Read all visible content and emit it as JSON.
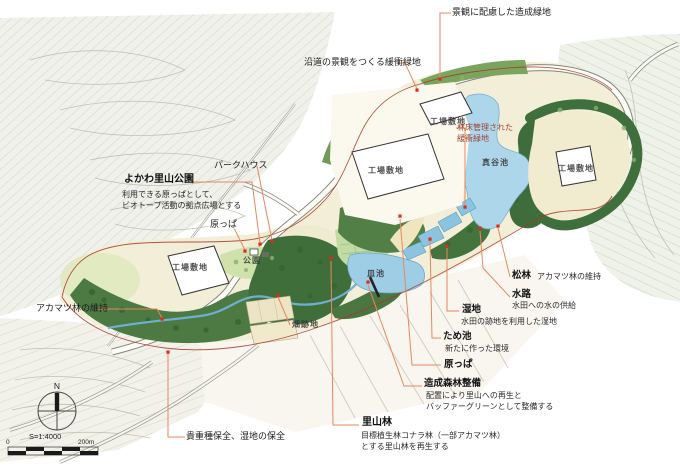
{
  "annotations": {
    "zosei_ryokuchi": {
      "label": "景観に配慮した造成緑地"
    },
    "enro": {
      "label": "沿道の景観をつくる緩衝緑地"
    },
    "parkhouse": {
      "label": "パークハウス"
    },
    "yokawa": {
      "title": "よかわ里山公園",
      "desc1": "利用できる原っぱとして、",
      "desc2": "ビオトープ活動の拠点広場とする"
    },
    "harappa_left": {
      "label": "原っぱ"
    },
    "akamatsu_left": {
      "label": "アカマツ林の維持"
    },
    "kicho": {
      "label": "貴重種保全、湿地の保全"
    },
    "rinsho": {
      "line1": "林床管理された",
      "line2": "緩衝緑地"
    },
    "matsubayashi": {
      "title": "松林",
      "desc": "アカマツ林の維持"
    },
    "suiro": {
      "title": "水路",
      "desc": "水田への水の供給"
    },
    "shitchi": {
      "title": "湿地",
      "desc": "水田の跡地を利用した湿地"
    },
    "tameike": {
      "title": "ため池",
      "desc": "新たに作った環境"
    },
    "harappa_right": {
      "label": "原っぱ"
    },
    "zosei_shinrin": {
      "title": "造成森林整備",
      "desc1": "配置により里山への再生と",
      "desc2": "バッファーグリーンとして整備する"
    },
    "satoyama": {
      "title": "里山林",
      "desc1": "目標植生林コナラ林（一部アカマツ林）",
      "desc2": "とする里山林を再生する"
    }
  },
  "map_labels": {
    "factory": "工場敷地",
    "mataniike": "真谷池",
    "saraike": "皿池",
    "koen": "公園",
    "hatakeato": "畑跡地"
  },
  "legend": {
    "north": "N",
    "scale": "S=1:4000",
    "scale_zero": "0",
    "scale_end": "200m"
  },
  "colors": {
    "leader_line": "#e8875f",
    "marker": "#dd2b1d",
    "boundary": "#a83828",
    "pond": "#aed6ea",
    "forest_dark": "#4a7741",
    "forest_light": "#cfe2ac",
    "site_cream": "#f3eed8"
  }
}
